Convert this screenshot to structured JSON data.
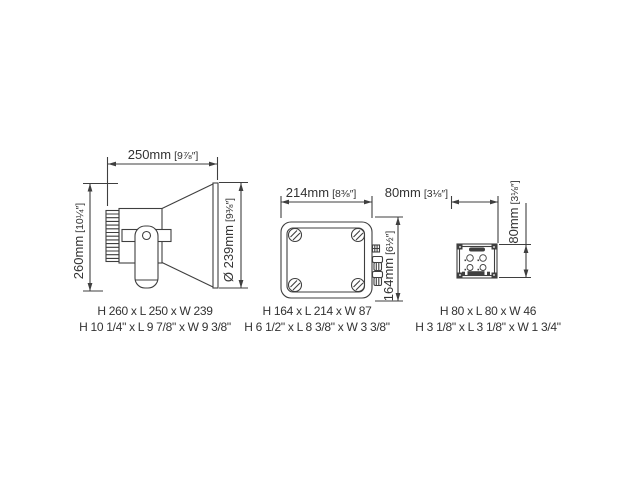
{
  "page": {
    "background": "#ffffff",
    "line_color": "#3f3f3f",
    "text_color": "#333333"
  },
  "drawings": {
    "horn": {
      "width": {
        "mm": "250mm",
        "in": "[9⅞″]"
      },
      "height": {
        "mm": "260mm",
        "in": "[10¼″]"
      },
      "diameter": {
        "mm": "Ø 239mm",
        "in": "[9⅜″]"
      },
      "caption_mm": "H 260 x L 250 x W 239",
      "caption_in": "H 10 1/4\" x L 9 7/8\" x W 9 3/8\""
    },
    "box": {
      "width": {
        "mm": "214mm",
        "in": "[8⅜″]"
      },
      "height": {
        "mm": "164mm",
        "in": "[6½″]"
      },
      "caption_mm": "H 164 x L 214 x W 87",
      "caption_in": "H 6 1/2\" x L 8 3/8\" x W 3 3/8\""
    },
    "unit": {
      "width": {
        "mm": "80mm",
        "in": "[3⅛″]"
      },
      "height": {
        "mm": "80mm",
        "in": "[3⅛″]"
      },
      "caption_mm": "H 80 x L 80 x W 46",
      "caption_in": "H 3 1/8\" x L 3 1/8\" x W 1 3/4\""
    }
  }
}
